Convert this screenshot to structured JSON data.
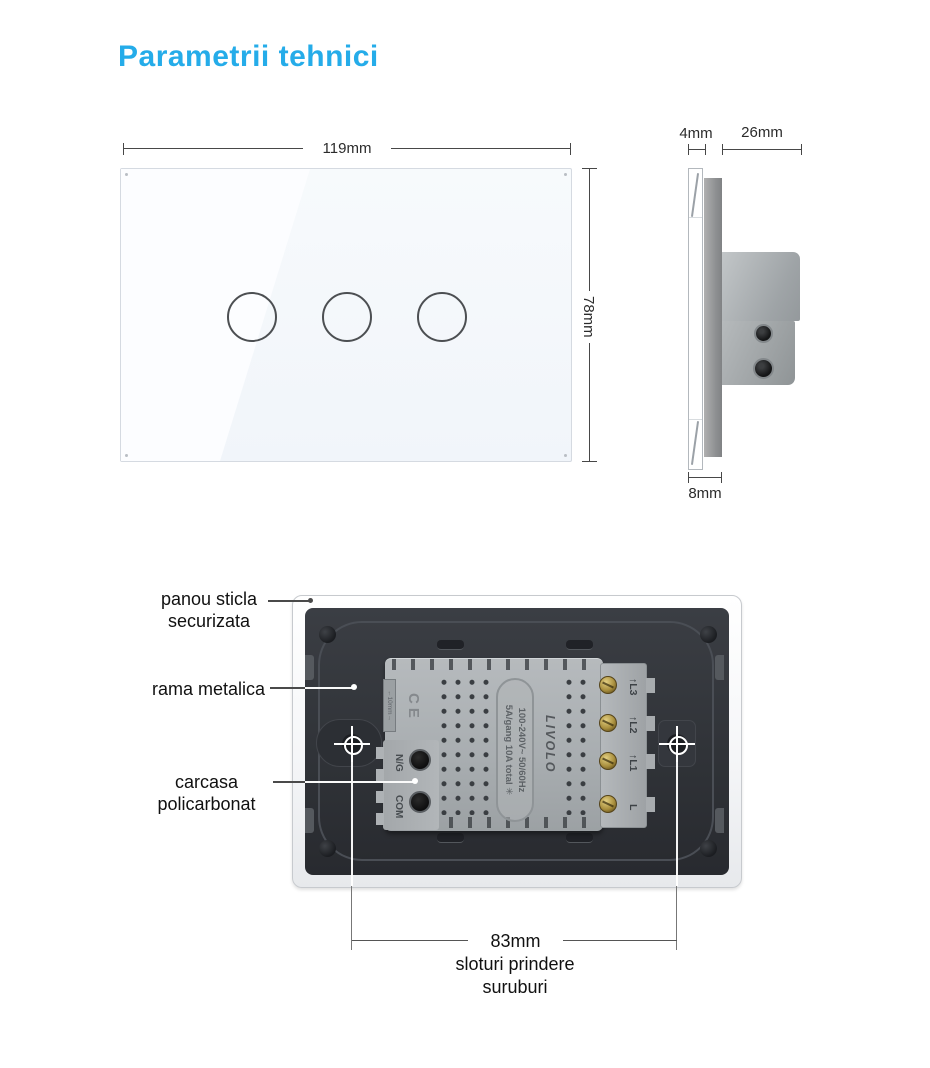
{
  "title": "Parametrii tehnici",
  "front_view": {
    "width_dim": "119mm",
    "height_dim": "78mm"
  },
  "side_view": {
    "glass_dim": "4mm",
    "depth_dim": "26mm",
    "thickness_dim": "8mm"
  },
  "back_view": {
    "callout_glass_line1": "panou sticla",
    "callout_glass_line2": "securizata",
    "callout_frame": "rama metalica",
    "callout_case_line1": "carcasa",
    "callout_case_line2": "policarbonat",
    "module": {
      "ce_mark": "CE",
      "gap_label": "←10mm→",
      "terminal_ng": "N/G",
      "terminal_com": "COM",
      "rating_line1": "100-240V~  50/60Hz",
      "rating_line2": "5A/gang  10A total ✳",
      "brand": "LIVOLO",
      "terminal_l3": "↑L3",
      "terminal_l2": "↑L2",
      "terminal_l1": "↑L1",
      "terminal_l": "L"
    },
    "screw_slots_dim": "83mm",
    "screw_slots_caption_line1": "sloturi prindere",
    "screw_slots_caption_line2": "suruburi"
  }
}
